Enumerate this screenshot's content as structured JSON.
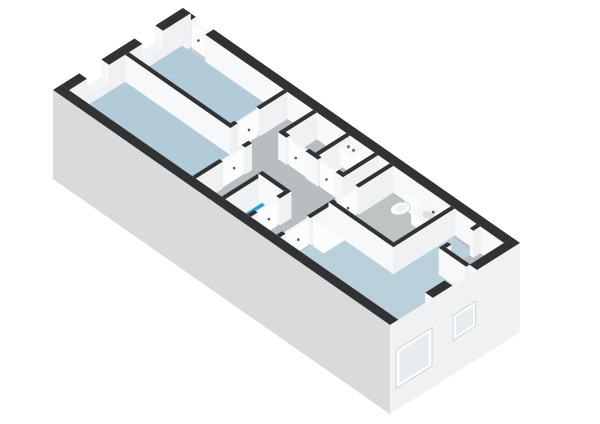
{
  "view": {
    "title": "3d-floorplan-isometric-view",
    "width": 600,
    "height": 424,
    "background": "#ffffff"
  },
  "projection": {
    "origin": [
      183,
      35
    ],
    "u": [
      25.53,
      17.8
    ],
    "v": [
      -27.66,
      17.45
    ],
    "z_px": 27,
    "building_size_m": [
      13.2,
      4.7
    ],
    "facade_drop": -2.3
  },
  "colors": {
    "slab": "#c9cccd",
    "floor_gray": "#b9bdbf",
    "floor_gray2": "#bfc3c4",
    "floor_blue": "#b3cbd8",
    "floor_blue2": "#bad0db",
    "floor_bright_blue": "#2d9ed3",
    "wall_top": "#303234",
    "sill_top": "#f3f5f6",
    "wall_east": "#eff1f2",
    "wall_west": "#dcdfe0",
    "wall_south": "#f7f8f9",
    "wall_north": "#c9cdcf",
    "white_lit": "#fbfcfc",
    "white_shade": "#e9ecee",
    "white_top": "#f4f6f7",
    "facade_front": "#d8dadb",
    "facade_right": "#f0f1f2",
    "window_frame": "#fdfdfd",
    "window_glass": "#e9ecee",
    "fixture_stroke": "#c7cbcd",
    "fixture_inner": "#eff2f3",
    "basin": "#dde1e3",
    "handle": "#55585a",
    "boiler_dot": "#73777a"
  },
  "rooms": [
    {
      "name": "bedroom-1",
      "floor": "blue"
    },
    {
      "name": "bedroom-2",
      "floor": "blue"
    },
    {
      "name": "hallway",
      "floor": "gray"
    },
    {
      "name": "wc-shower",
      "floor": "bright-blue"
    },
    {
      "name": "bathroom",
      "floor": "gray"
    },
    {
      "name": "living-room",
      "floor": "blue"
    },
    {
      "name": "storage-room",
      "floor": "gray"
    }
  ],
  "floors": [
    {
      "n": "floor-slab",
      "c": "slab",
      "poly": [
        [
          0,
          0
        ],
        [
          13.2,
          0
        ],
        [
          13.2,
          4.7
        ],
        [
          0,
          4.7
        ]
      ]
    },
    {
      "n": "hallway-floor",
      "c": "floor_gray",
      "poly": [
        [
          0.3,
          0.3
        ],
        [
          12.9,
          0.3
        ],
        [
          12.9,
          4.4
        ],
        [
          0.3,
          4.4
        ]
      ]
    },
    {
      "n": "bedroom-1-floor",
      "c": "floor_blue",
      "poly": [
        [
          0.3,
          0.3
        ],
        [
          4.28,
          0.3
        ],
        [
          4.28,
          2.23
        ],
        [
          0.3,
          2.23
        ]
      ]
    },
    {
      "n": "bedroom-2-floor",
      "c": "floor_blue",
      "poly": [
        [
          0.3,
          2.37
        ],
        [
          5.13,
          2.37
        ],
        [
          5.13,
          4.4
        ],
        [
          0.3,
          4.4
        ]
      ]
    },
    {
      "n": "wc-floor",
      "c": "floor_bright_blue",
      "poly": [
        [
          6.42,
          3.07
        ],
        [
          7.28,
          3.07
        ],
        [
          7.28,
          4.4
        ],
        [
          6.42,
          4.4
        ]
      ]
    },
    {
      "n": "bathroom-floor",
      "c": "floor_gray2",
      "poly": [
        [
          8.57,
          0.37
        ],
        [
          10.83,
          0.37
        ],
        [
          10.83,
          2.38
        ],
        [
          8.57,
          2.38
        ]
      ]
    },
    {
      "n": "living-room-floor",
      "c": "floor_blue2",
      "poly": [
        [
          8.57,
          2.52
        ],
        [
          10.97,
          2.52
        ],
        [
          10.97,
          0.37
        ],
        [
          11.83,
          0.37
        ],
        [
          11.83,
          1.67
        ],
        [
          12.9,
          1.67
        ],
        [
          12.9,
          4.4
        ],
        [
          8.57,
          4.4
        ]
      ]
    },
    {
      "n": "storage-floor",
      "c": "floor_gray",
      "poly": [
        [
          11.97,
          0.37
        ],
        [
          12.9,
          0.37
        ],
        [
          12.9,
          1.53
        ],
        [
          11.97,
          1.53
        ]
      ]
    }
  ],
  "elements": [
    {
      "n": "back-wall-a",
      "t": "wall",
      "a": [
        0,
        0.15
      ],
      "b": [
        0.5,
        0.15
      ],
      "th": 0.3
    },
    {
      "n": "back-door",
      "t": "door",
      "a": [
        0.55,
        0.15
      ],
      "b": [
        1.15,
        0.15
      ],
      "th": 0.07,
      "z": [
        0,
        0.96
      ]
    },
    {
      "n": "back-wall-b",
      "t": "wall",
      "a": [
        1.2,
        0.15
      ],
      "b": [
        13.2,
        0.15
      ],
      "th": 0.3
    },
    {
      "n": "left-wall-a",
      "t": "wall",
      "a": [
        0.15,
        0
      ],
      "b": [
        0.15,
        1.0
      ],
      "th": 0.3
    },
    {
      "n": "bedroom-1-window-sill",
      "t": "wall",
      "a": [
        0.15,
        1.0
      ],
      "b": [
        0.15,
        1.75
      ],
      "th": 0.3,
      "z": [
        0,
        0.35
      ],
      "top": "light"
    },
    {
      "n": "left-wall-b",
      "t": "wall",
      "a": [
        0.15,
        1.75
      ],
      "b": [
        0.15,
        2.95
      ],
      "th": 0.3
    },
    {
      "n": "bedroom-2-window-sill",
      "t": "wall",
      "a": [
        0.15,
        2.95
      ],
      "b": [
        0.15,
        3.75
      ],
      "th": 0.3,
      "z": [
        0,
        0.35
      ],
      "top": "light"
    },
    {
      "n": "left-wall-c",
      "t": "wall",
      "a": [
        0.15,
        3.75
      ],
      "b": [
        0.15,
        4.7
      ],
      "th": 0.3
    },
    {
      "n": "bedroom-1-wall-a",
      "t": "wall",
      "a": [
        4.35,
        0.3
      ],
      "b": [
        4.35,
        1.3
      ]
    },
    {
      "n": "bedroom-1-door",
      "t": "door",
      "a": [
        4.35,
        1.35
      ],
      "b": [
        4.35,
        2.05
      ],
      "th": 0.07,
      "z": [
        0,
        0.96
      ]
    },
    {
      "n": "bedroom-1-wall-b",
      "t": "wall",
      "a": [
        4.35,
        2.1
      ],
      "b": [
        4.35,
        2.37
      ]
    },
    {
      "n": "bedroom-partition-wall",
      "t": "wall",
      "a": [
        0.3,
        2.3
      ],
      "b": [
        4.42,
        2.3
      ]
    },
    {
      "n": "closet-wall-1",
      "t": "wall",
      "a": [
        5.5,
        0.3
      ],
      "b": [
        5.5,
        1.5
      ]
    },
    {
      "n": "closet-wall-2",
      "t": "wall",
      "a": [
        6.8,
        0.3
      ],
      "b": [
        6.8,
        1.5
      ]
    },
    {
      "n": "boiler-unit",
      "t": "box",
      "a": [
        6.98,
        0.6
      ],
      "b": [
        7.48,
        0.6
      ],
      "th": 0.36,
      "z": [
        0.28,
        0.95
      ],
      "dots": true
    },
    {
      "n": "closet-wall-3",
      "t": "wall",
      "a": [
        7.9,
        0.3
      ],
      "b": [
        7.9,
        1.5
      ]
    },
    {
      "n": "closet-front-wall-a",
      "t": "wall",
      "a": [
        5.43,
        1.5
      ],
      "b": [
        5.75,
        1.5
      ]
    },
    {
      "n": "closet-door-1",
      "t": "door",
      "a": [
        5.8,
        1.5
      ],
      "b": [
        6.45,
        1.5
      ],
      "th": 0.07,
      "z": [
        0,
        0.96
      ]
    },
    {
      "n": "closet-front-wall-b",
      "t": "wall",
      "a": [
        6.5,
        1.5
      ],
      "b": [
        6.98,
        1.5
      ]
    },
    {
      "n": "closet-door-2",
      "t": "door",
      "a": [
        7.03,
        1.5
      ],
      "b": [
        7.63,
        1.5
      ],
      "th": 0.07,
      "z": [
        0,
        0.96
      ]
    },
    {
      "n": "closet-front-wall-c",
      "t": "wall",
      "a": [
        7.68,
        1.5
      ],
      "b": [
        7.97,
        1.5
      ]
    },
    {
      "n": "bedroom-2-wall-a",
      "t": "wall",
      "a": [
        5.2,
        2.37
      ],
      "b": [
        5.2,
        2.62
      ]
    },
    {
      "n": "bedroom-2-door",
      "t": "door",
      "a": [
        5.2,
        2.66
      ],
      "b": [
        5.2,
        3.38
      ],
      "th": 0.07,
      "z": [
        0,
        0.96
      ]
    },
    {
      "n": "bedroom-2-wall-b",
      "t": "wall",
      "a": [
        5.2,
        3.42
      ],
      "b": [
        5.2,
        4.4
      ]
    },
    {
      "n": "wc-wall-left",
      "t": "wall",
      "a": [
        6.35,
        3.0
      ],
      "b": [
        6.35,
        4.4
      ]
    },
    {
      "n": "wc-wall-back",
      "t": "wall",
      "a": [
        6.28,
        3.0
      ],
      "b": [
        7.42,
        3.0
      ]
    },
    {
      "n": "wc-wall-right-a",
      "t": "wall",
      "a": [
        7.35,
        3.0
      ],
      "b": [
        7.35,
        3.35
      ]
    },
    {
      "n": "wc-door",
      "t": "door",
      "a": [
        7.35,
        3.4
      ],
      "b": [
        7.35,
        4.1
      ],
      "th": 0.07,
      "z": [
        0,
        0.96
      ]
    },
    {
      "n": "wc-wall-right-b",
      "t": "wall",
      "a": [
        7.35,
        4.15
      ],
      "b": [
        7.35,
        4.4
      ]
    },
    {
      "n": "hall-living-wall-a",
      "t": "wall",
      "a": [
        8.5,
        0.3
      ],
      "b": [
        8.5,
        1.55
      ]
    },
    {
      "n": "bathroom-door",
      "t": "door",
      "a": [
        8.5,
        1.6
      ],
      "b": [
        8.5,
        2.3
      ],
      "th": 0.07,
      "z": [
        0,
        0.96
      ]
    },
    {
      "n": "hall-living-wall-b",
      "t": "wall",
      "a": [
        8.5,
        2.35
      ],
      "b": [
        8.5,
        3.3
      ]
    },
    {
      "n": "wardrobe",
      "t": "box",
      "a": [
        8.64,
        2.9
      ],
      "b": [
        9.06,
        2.9
      ],
      "th": 0.76,
      "z": [
        0,
        1
      ]
    },
    {
      "n": "living-room-door",
      "t": "door",
      "a": [
        8.5,
        3.35
      ],
      "b": [
        8.5,
        4.15
      ],
      "th": 0.07,
      "z": [
        0,
        0.96
      ]
    },
    {
      "n": "hall-living-wall-c",
      "t": "wall",
      "a": [
        8.5,
        4.2
      ],
      "b": [
        8.5,
        4.4
      ]
    },
    {
      "n": "toilet",
      "t": "toilet",
      "c": [
        9.45,
        0.86
      ]
    },
    {
      "n": "washbasin-counter",
      "t": "counter",
      "a": [
        9.82,
        0.58
      ],
      "b": [
        10.52,
        0.58
      ],
      "th": 0.48,
      "z": [
        0,
        0.46
      ]
    },
    {
      "n": "washing-machine",
      "t": "washer",
      "a": [
        10.74,
        0.34
      ],
      "b": [
        10.74,
        1.02
      ],
      "th": 0.32,
      "z": [
        0,
        0.5
      ]
    },
    {
      "n": "bathroom-front-wall",
      "t": "wall",
      "a": [
        8.43,
        2.45
      ],
      "b": [
        10.97,
        2.45
      ]
    },
    {
      "n": "bathroom-right-wall",
      "t": "wall",
      "a": [
        10.9,
        0.3
      ],
      "b": [
        10.9,
        2.52
      ]
    },
    {
      "n": "storage-wall-a",
      "t": "wall",
      "a": [
        11.9,
        0.3
      ],
      "b": [
        11.9,
        0.55
      ]
    },
    {
      "n": "storage-wall-b",
      "t": "wall",
      "a": [
        11.9,
        1.35
      ],
      "b": [
        11.9,
        1.6
      ]
    },
    {
      "n": "storage-front-wall",
      "t": "wall",
      "a": [
        11.83,
        1.6
      ],
      "b": [
        12.9,
        1.6
      ]
    },
    {
      "n": "right-wall-a",
      "t": "wall",
      "a": [
        13.05,
        0
      ],
      "b": [
        13.05,
        1.55
      ],
      "th": 0.3
    },
    {
      "n": "living-window-sill-1",
      "t": "wall",
      "a": [
        13.05,
        1.55
      ],
      "b": [
        13.05,
        2.45
      ],
      "th": 0.3,
      "z": [
        0,
        0.35
      ],
      "top": "light"
    },
    {
      "n": "right-wall-b",
      "t": "wall",
      "a": [
        13.05,
        2.45
      ],
      "b": [
        13.05,
        3.15
      ],
      "th": 0.3
    },
    {
      "n": "living-window-sill-2",
      "t": "wall",
      "a": [
        13.05,
        3.15
      ],
      "b": [
        13.05,
        4.5
      ],
      "th": 0.3,
      "z": [
        0,
        0.3
      ],
      "top": "light"
    },
    {
      "n": "right-wall-c",
      "t": "wall",
      "a": [
        13.05,
        4.5
      ],
      "b": [
        13.05,
        4.7
      ],
      "th": 0.3
    },
    {
      "n": "front-wall",
      "t": "wall",
      "a": [
        0,
        4.55
      ],
      "b": [
        13.2,
        4.55
      ],
      "th": 0.3
    }
  ],
  "facades": [
    {
      "n": "facade-front",
      "a": [
        0,
        4.7
      ],
      "b": [
        13.2,
        4.7
      ],
      "c": "facade_front",
      "windows": []
    },
    {
      "n": "facade-right",
      "a": [
        13.2,
        4.7
      ],
      "b": [
        13.2,
        0
      ],
      "c": "facade_right",
      "windows": [
        {
          "n": "living-facade-window-large",
          "frame": {
            "a": [
              13.2,
              4.48
            ],
            "b": [
              13.2,
              3.18
            ],
            "z": [
              -0.08,
              -1.5
            ]
          },
          "glass": {
            "a": [
              13.2,
              4.36
            ],
            "b": [
              13.2,
              3.3
            ],
            "z": [
              -0.2,
              -1.38
            ]
          }
        },
        {
          "n": "living-facade-window-small",
          "frame": {
            "a": [
              13.2,
              2.42
            ],
            "b": [
              13.2,
              1.6
            ],
            "z": [
              -0.12,
              -1.05
            ]
          },
          "glass": {
            "a": [
              13.2,
              2.32
            ],
            "b": [
              13.2,
              1.7
            ],
            "z": [
              -0.24,
              -0.93
            ]
          }
        }
      ]
    }
  ]
}
